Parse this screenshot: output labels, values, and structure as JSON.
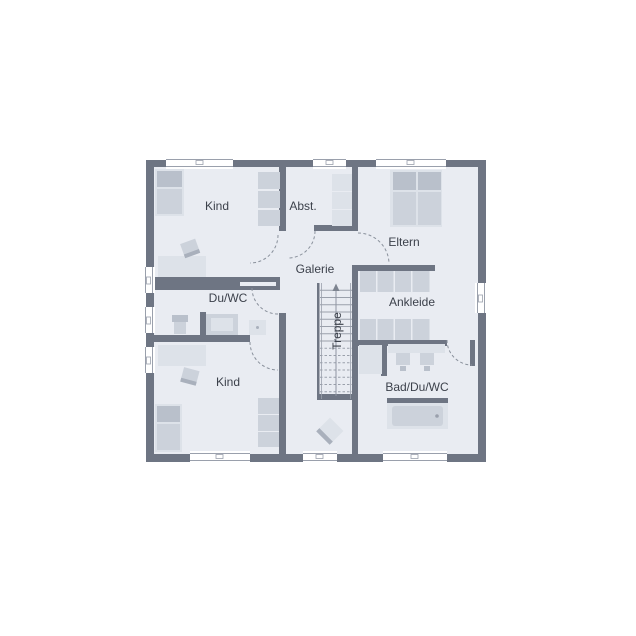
{
  "plan": {
    "type": "floor-plan-upper-storey",
    "rooms": {
      "kind_top": {
        "label": "Kind"
      },
      "abst": {
        "label": "Abst."
      },
      "eltern": {
        "label": "Eltern"
      },
      "galerie": {
        "label": "Galerie"
      },
      "du_wc": {
        "label": "Du/WC"
      },
      "ankleide": {
        "label": "Ankleide"
      },
      "treppe": {
        "label": "Treppe"
      },
      "kind_bottom": {
        "label": "Kind"
      },
      "bad_du_wc": {
        "label": "Bad/Du/WC"
      }
    },
    "colors": {
      "background": "#ffffff",
      "wall": "#6e7583",
      "floor": "#e9ecf2",
      "furniture_light": "#dde2e9",
      "furniture_mid": "#ccd2db",
      "furniture_dark": "#b9c0cb",
      "furniture_deep": "#a9b0bc",
      "window_frame": "#9aa0ac",
      "stair_line": "#9aa0ab",
      "door_arc": "#8a919c",
      "label_text": "#3c414b"
    }
  }
}
